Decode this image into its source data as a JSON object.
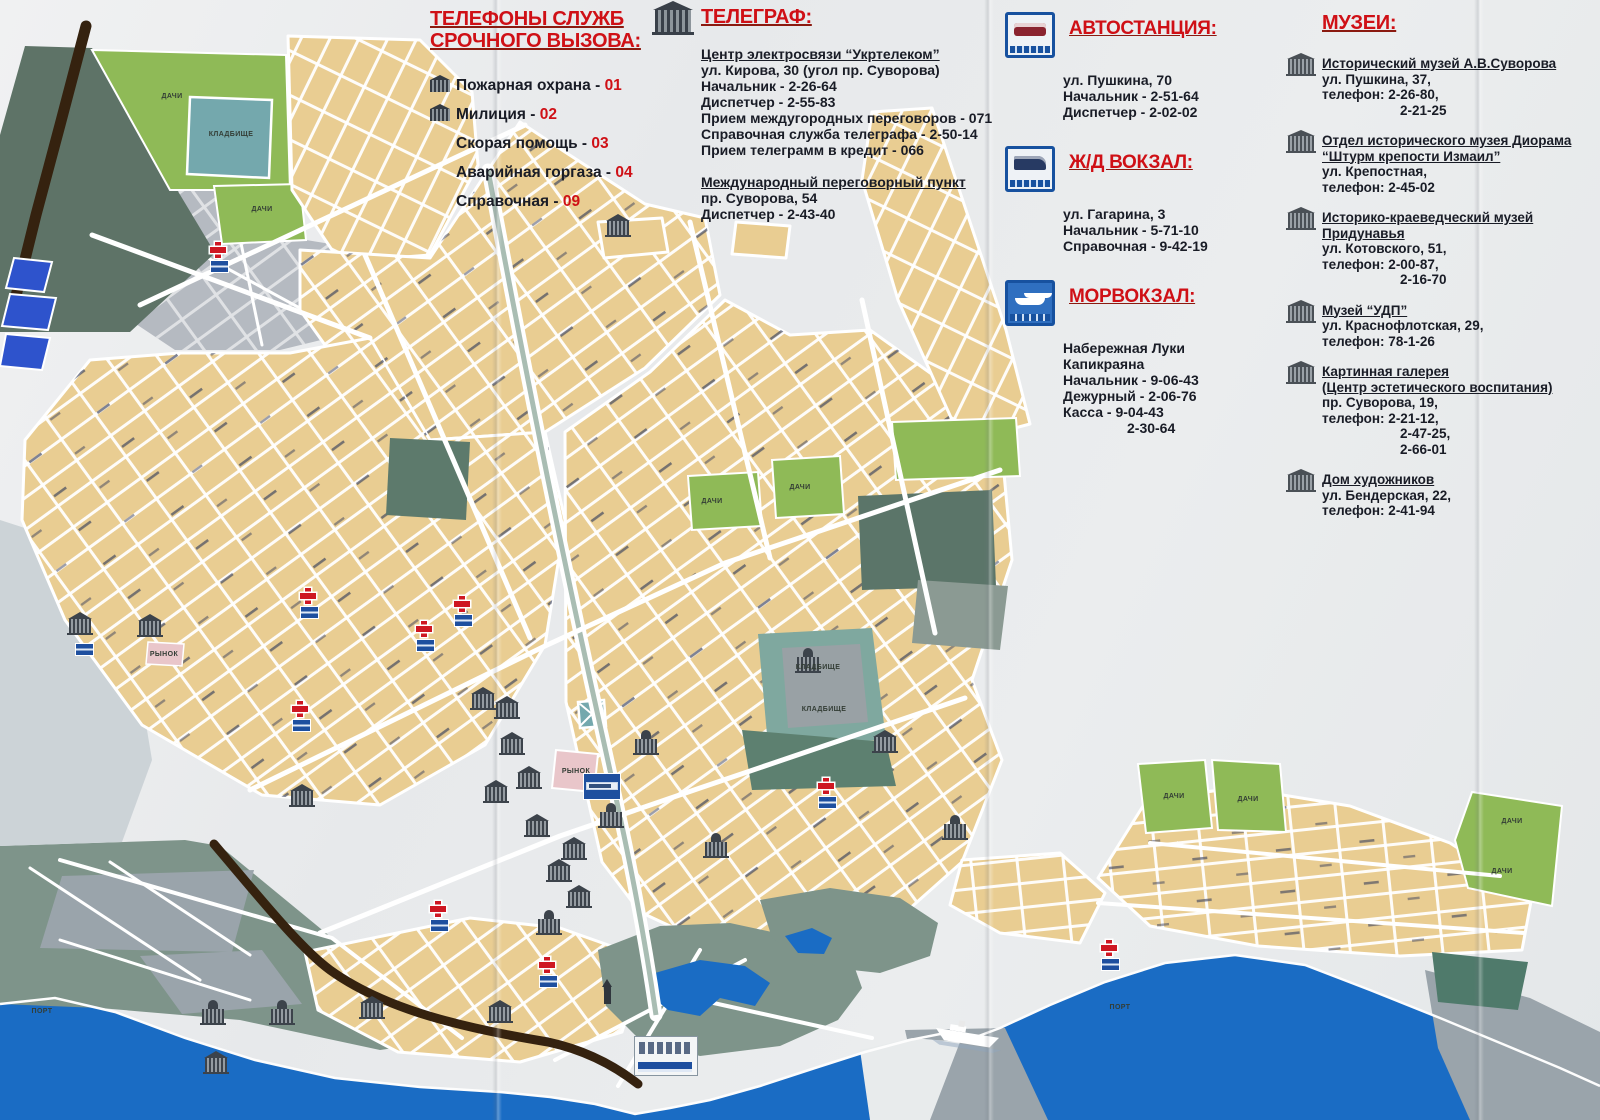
{
  "panels": {
    "emergency": {
      "title_line1": "ТЕЛЕФОНЫ СЛУЖБ",
      "title_line2": "СРОЧНОГО ВЫЗОВА:",
      "items": [
        {
          "label": "Пожарная охрана",
          "number": "01"
        },
        {
          "label": "Милиция",
          "number": "02"
        },
        {
          "label": "Скорая помощь",
          "number": "03"
        },
        {
          "label": "Аварийная горгаза",
          "number": "04"
        },
        {
          "label": "Справочная",
          "number": "09"
        }
      ]
    },
    "telegraph": {
      "title": "ТЕЛЕГРАФ:",
      "heading1": "Центр электросвязи “Укртелеком”",
      "s1_lines": [
        "ул. Кирова, 30 (угол пр. Суворова)",
        "Начальник - 2-26-64",
        "Диспетчер - 2-55-83",
        "Прием междугородных переговоров - 071",
        "Справочная служба телеграфа - 2-50-14",
        "Прием телеграмм в кредит - 066"
      ],
      "heading2": "Международный переговорный пункт",
      "s2_lines": [
        "пр. Суворова, 54",
        "Диспетчер - 2-43-40"
      ]
    },
    "bus_station": {
      "title": "АВТОСТАНЦИЯ:",
      "lines": [
        "ул. Пушкина, 70",
        "Начальник - 2-51-64",
        "Диспетчер - 2-02-02"
      ]
    },
    "rail_station": {
      "title": "Ж/Д ВОКЗАЛ:",
      "lines": [
        "ул. Гагарина, 3",
        "Начальник - 5-71-10",
        "Справочная - 9-42-19"
      ]
    },
    "sea_terminal": {
      "title": "МОРВОКЗАЛ:",
      "lines": [
        "Набережная Луки",
        "Капикраяна",
        "Начальник - 9-06-43",
        "Дежурный - 2-06-76",
        "Касса - 9-04-43"
      ],
      "line_indent": "2-30-64"
    },
    "museums": {
      "title": "МУЗЕИ:",
      "items": [
        {
          "name1": "Исторический музей А.В.Суворова",
          "name2": "",
          "l1": "ул. Пушкина, 37,",
          "l2": "телефон: 2-26-80,",
          "l3": "2-21-25",
          "l4": ""
        },
        {
          "name1": "Отдел исторического музея Диорама",
          "name2": "“Штурм крепости Измаил”",
          "l1": "ул. Крепостная,",
          "l2": "телефон: 2-45-02",
          "l3": "",
          "l4": ""
        },
        {
          "name1": "Историко-краеведческий музей",
          "name2": "Придунавья",
          "l1": "ул. Котовского, 51,",
          "l2": "телефон: 2-00-87,",
          "l3": "2-16-70",
          "l4": ""
        },
        {
          "name1": "Музей “УДП”",
          "name2": "",
          "l1": "ул. Краснофлотская, 29,",
          "l2": "телефон: 78-1-26",
          "l3": "",
          "l4": ""
        },
        {
          "name1": "Картинная галерея",
          "name2": "(Центр эстетического воспитания)",
          "l1": "пр. Суворова, 19,",
          "l2": "телефон: 2-21-12,",
          "l3": "2-47-25,",
          "l4": "2-66-01"
        },
        {
          "name1": "Дом художников",
          "name2": "",
          "l1": "ул. Бендерская, 22,",
          "l2": "телефон: 2-41-94",
          "l3": "",
          "l4": ""
        }
      ]
    }
  },
  "map": {
    "colors": {
      "water": "#1a6cc4",
      "block": "#e9cd92",
      "green": "#8fba57",
      "teal": "#74a8ad",
      "park": "#7e948a",
      "district": "#b5bac1",
      "industrial": "#9aa4ab",
      "wedge": "#5e7367",
      "rail": "#35220f",
      "sign_blue": "#1e4f9f",
      "cross_red": "#ce1722",
      "title_red": "#cf1016",
      "text_dark": "#191c26",
      "market_pink": "#e9c6ca"
    },
    "labels": [
      {
        "t": "ДАЧИ",
        "x": 172,
        "y": 93
      },
      {
        "t": "КЛАДБИЩЕ",
        "x": 231,
        "y": 131
      },
      {
        "t": "ДАЧИ",
        "x": 262,
        "y": 206
      },
      {
        "t": "ДАЧИ",
        "x": 712,
        "y": 498
      },
      {
        "t": "ДАЧИ",
        "x": 800,
        "y": 484
      },
      {
        "t": "КЛАДБИЩЕ",
        "x": 818,
        "y": 664
      },
      {
        "t": "КЛАДБИЩЕ",
        "x": 824,
        "y": 706
      },
      {
        "t": "РЫНОК",
        "x": 576,
        "y": 768
      },
      {
        "t": "РЫНОК",
        "x": 164,
        "y": 651
      },
      {
        "t": "ДАЧИ",
        "x": 1174,
        "y": 793
      },
      {
        "t": "ДАЧИ",
        "x": 1248,
        "y": 796
      },
      {
        "t": "ДАЧИ",
        "x": 1512,
        "y": 818
      },
      {
        "t": "ДАЧИ",
        "x": 1502,
        "y": 868
      },
      {
        "t": "ПОРТ",
        "x": 1120,
        "y": 1004
      },
      {
        "t": "ПОРТ",
        "x": 42,
        "y": 1008
      }
    ],
    "hospitals": [
      [
        218,
        250
      ],
      [
        308,
        596
      ],
      [
        462,
        604
      ],
      [
        424,
        629
      ],
      [
        300,
        709
      ],
      [
        826,
        786
      ],
      [
        438,
        909
      ],
      [
        547,
        965
      ],
      [
        1109,
        948
      ]
    ],
    "signs": [
      [
        75,
        643
      ]
    ],
    "buildings": [
      [
        483,
        701,
        "b"
      ],
      [
        507,
        710,
        "b"
      ],
      [
        512,
        746,
        "b"
      ],
      [
        529,
        780,
        "b"
      ],
      [
        496,
        794,
        "b"
      ],
      [
        537,
        828,
        "b"
      ],
      [
        559,
        873,
        "b"
      ],
      [
        574,
        851,
        "b"
      ],
      [
        579,
        899,
        "b"
      ],
      [
        549,
        926,
        "c"
      ],
      [
        611,
        819,
        "c"
      ],
      [
        716,
        849,
        "c"
      ],
      [
        646,
        746,
        "c"
      ],
      [
        955,
        831,
        "c"
      ],
      [
        808,
        664,
        "c"
      ],
      [
        213,
        1016,
        "c"
      ],
      [
        282,
        1016,
        "c"
      ],
      [
        216,
        1065,
        "b"
      ],
      [
        618,
        228,
        "b"
      ],
      [
        372,
        1010,
        "b"
      ],
      [
        500,
        1014,
        "b"
      ],
      [
        150,
        628,
        "b"
      ],
      [
        80,
        626,
        "b"
      ],
      [
        302,
        798,
        "b"
      ],
      [
        885,
        744,
        "b"
      ]
    ],
    "monument": {
      "x": 604,
      "y": 986
    }
  }
}
